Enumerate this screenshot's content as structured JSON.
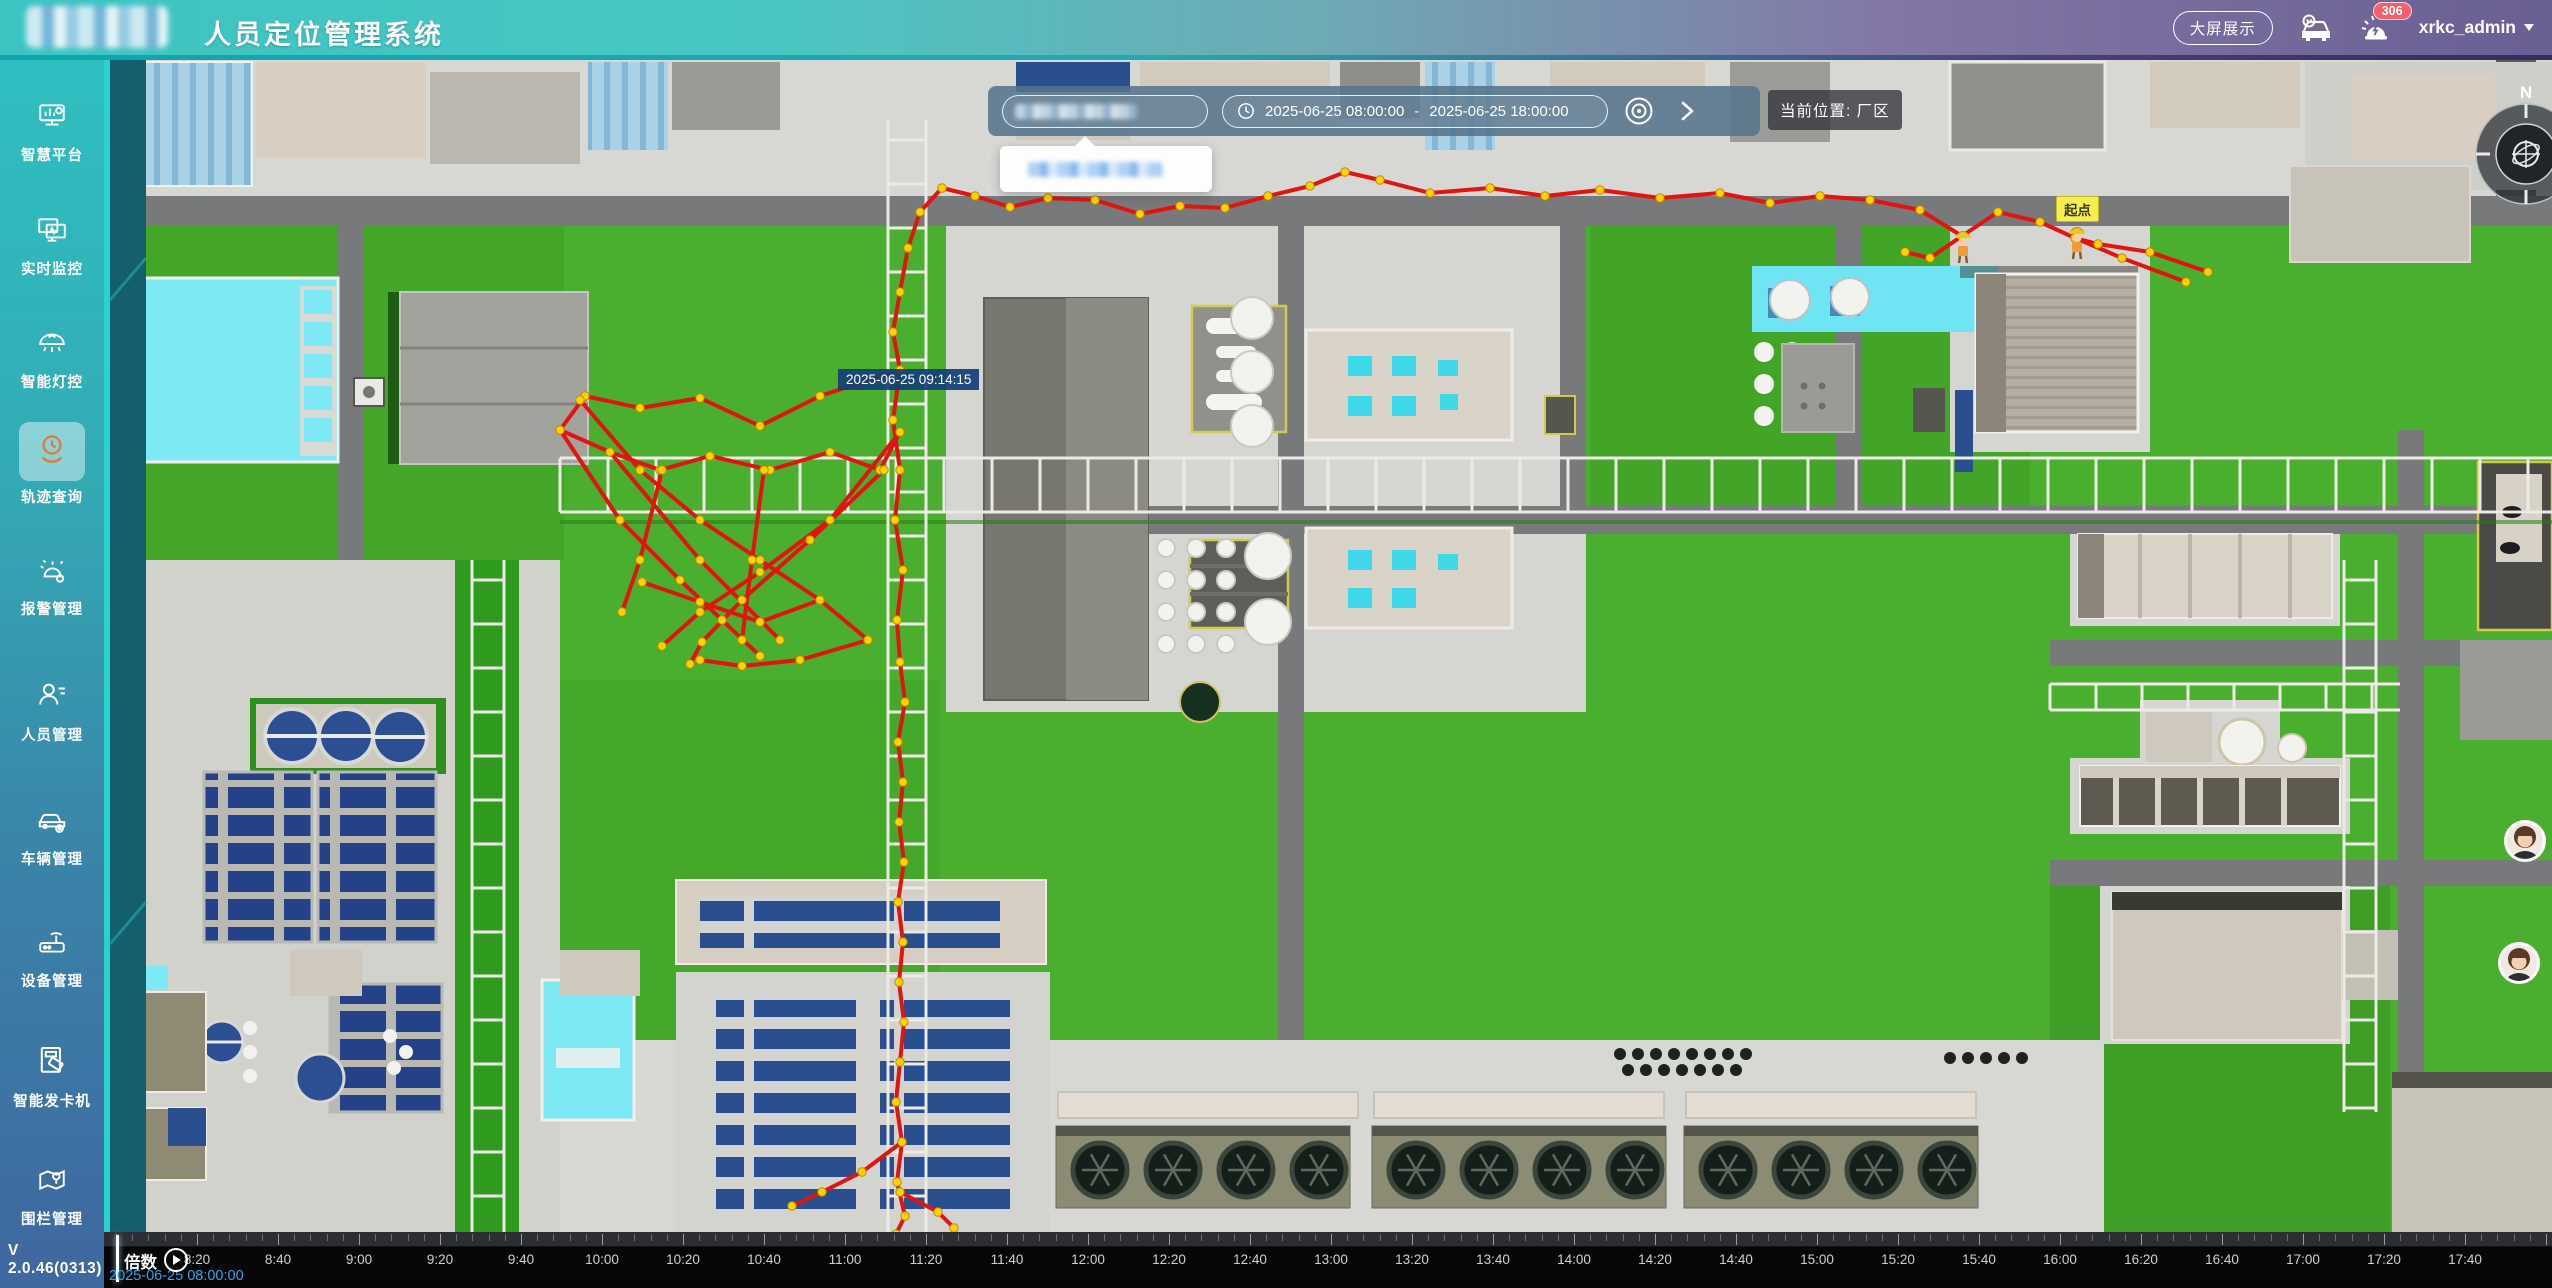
{
  "header": {
    "title": "人员定位管理系统",
    "big_screen_button": "大屏展示",
    "notification_count": "306",
    "username": "xrkc_admin"
  },
  "sidebar": {
    "items": [
      {
        "label": "智慧平台"
      },
      {
        "label": "实时监控"
      },
      {
        "label": "智能灯控"
      },
      {
        "label": "轨迹查询"
      },
      {
        "label": "报警管理"
      },
      {
        "label": "人员管理"
      },
      {
        "label": "车辆管理"
      },
      {
        "label": "设备管理"
      },
      {
        "label": "智能发卡机"
      },
      {
        "label": "围栏管理"
      }
    ],
    "active_index": 3,
    "version": "V 2.0.46(0313)"
  },
  "toolbar": {
    "date_start": "2025-06-25 08:00:00",
    "date_separator": "-",
    "date_end": "2025-06-25 18:00:00",
    "location_label": "当前位置: 厂区"
  },
  "map": {
    "start_label": "起点",
    "tooltip_time": "2025-06-25 09:14:15",
    "trail_color": "#e21410",
    "dot_color": "#ffd200",
    "dot_stroke": "#bf8a00",
    "trail_polylines": [
      [
        [
          2208,
          272
        ],
        [
          2150,
          252
        ],
        [
          2098,
          244
        ],
        [
          2075,
          238
        ],
        [
          2040,
          222
        ],
        [
          1998,
          212
        ],
        [
          1962,
          236
        ],
        [
          1920,
          210
        ],
        [
          1870,
          200
        ],
        [
          1820,
          196
        ],
        [
          1770,
          203
        ],
        [
          1720,
          193
        ],
        [
          1660,
          198
        ],
        [
          1600,
          190
        ],
        [
          1545,
          196
        ],
        [
          1490,
          188
        ],
        [
          1430,
          193
        ],
        [
          1380,
          180
        ],
        [
          1345,
          172
        ],
        [
          1310,
          186
        ],
        [
          1268,
          196
        ],
        [
          1225,
          208
        ],
        [
          1180,
          206
        ],
        [
          1140,
          214
        ],
        [
          1095,
          200
        ],
        [
          1048,
          198
        ],
        [
          1010,
          207
        ],
        [
          975,
          196
        ],
        [
          942,
          188
        ],
        [
          920,
          212
        ],
        [
          908,
          248
        ],
        [
          900,
          292
        ],
        [
          893,
          332
        ],
        [
          900,
          370
        ]
      ],
      [
        [
          2075,
          238
        ],
        [
          2122,
          258
        ],
        [
          2186,
          282
        ]
      ],
      [
        [
          1962,
          236
        ],
        [
          1930,
          258
        ],
        [
          1905,
          252
        ]
      ],
      [
        [
          900,
          370
        ],
        [
          820,
          396
        ],
        [
          760,
          426
        ],
        [
          700,
          398
        ],
        [
          640,
          408
        ],
        [
          585,
          396
        ],
        [
          560,
          430
        ],
        [
          610,
          452
        ],
        [
          660,
          470
        ],
        [
          710,
          456
        ],
        [
          770,
          470
        ],
        [
          830,
          452
        ],
        [
          880,
          470
        ],
        [
          900,
          432
        ]
      ],
      [
        [
          580,
          400
        ],
        [
          640,
          470
        ],
        [
          700,
          520
        ],
        [
          760,
          560
        ],
        [
          820,
          600
        ],
        [
          868,
          640
        ]
      ],
      [
        [
          900,
          432
        ],
        [
          830,
          520
        ],
        [
          760,
          572
        ],
        [
          700,
          612
        ],
        [
          662,
          646
        ]
      ],
      [
        [
          560,
          430
        ],
        [
          620,
          520
        ],
        [
          680,
          580
        ],
        [
          722,
          620
        ],
        [
          760,
          656
        ]
      ],
      [
        [
          884,
          470
        ],
        [
          810,
          540
        ],
        [
          742,
          600
        ],
        [
          702,
          642
        ],
        [
          690,
          664
        ]
      ],
      [
        [
          610,
          452
        ],
        [
          700,
          560
        ],
        [
          780,
          640
        ]
      ],
      [
        [
          662,
          470
        ],
        [
          640,
          560
        ],
        [
          622,
          612
        ]
      ],
      [
        [
          764,
          470
        ],
        [
          752,
          560
        ],
        [
          742,
          640
        ]
      ],
      [
        [
          820,
          600
        ],
        [
          760,
          622
        ],
        [
          700,
          602
        ],
        [
          642,
          582
        ]
      ],
      [
        [
          868,
          640
        ],
        [
          800,
          660
        ],
        [
          742,
          666
        ],
        [
          700,
          660
        ]
      ],
      [
        [
          900,
          370
        ],
        [
          893,
          420
        ],
        [
          900,
          470
        ],
        [
          895,
          520
        ],
        [
          903,
          570
        ],
        [
          897,
          620
        ],
        [
          900,
          662
        ],
        [
          905,
          702
        ],
        [
          898,
          742
        ],
        [
          903,
          782
        ],
        [
          899,
          822
        ],
        [
          904,
          862
        ],
        [
          898,
          902
        ],
        [
          903,
          942
        ],
        [
          899,
          982
        ],
        [
          904,
          1022
        ],
        [
          900,
          1062
        ],
        [
          896,
          1102
        ],
        [
          902,
          1142
        ],
        [
          897,
          1182
        ],
        [
          905,
          1216
        ],
        [
          896,
          1234
        ]
      ],
      [
        [
          902,
          1142
        ],
        [
          862,
          1172
        ],
        [
          822,
          1192
        ],
        [
          792,
          1206
        ]
      ],
      [
        [
          900,
          1192
        ],
        [
          938,
          1212
        ],
        [
          954,
          1228
        ]
      ]
    ]
  },
  "timeline": {
    "speed_label": "倍数",
    "current_time": "2025-06-25 08:00:00",
    "labels": [
      "8:20",
      "8:40",
      "9:00",
      "9:20",
      "9:40",
      "10:00",
      "10:20",
      "10:40",
      "11:00",
      "11:20",
      "11:40",
      "12:00",
      "12:20",
      "12:40",
      "13:00",
      "13:20",
      "13:40",
      "14:00",
      "14:20",
      "14:40",
      "15:00",
      "15:20",
      "15:40",
      "16:00",
      "16:20",
      "16:40",
      "17:00",
      "17:20",
      "17:40"
    ]
  }
}
